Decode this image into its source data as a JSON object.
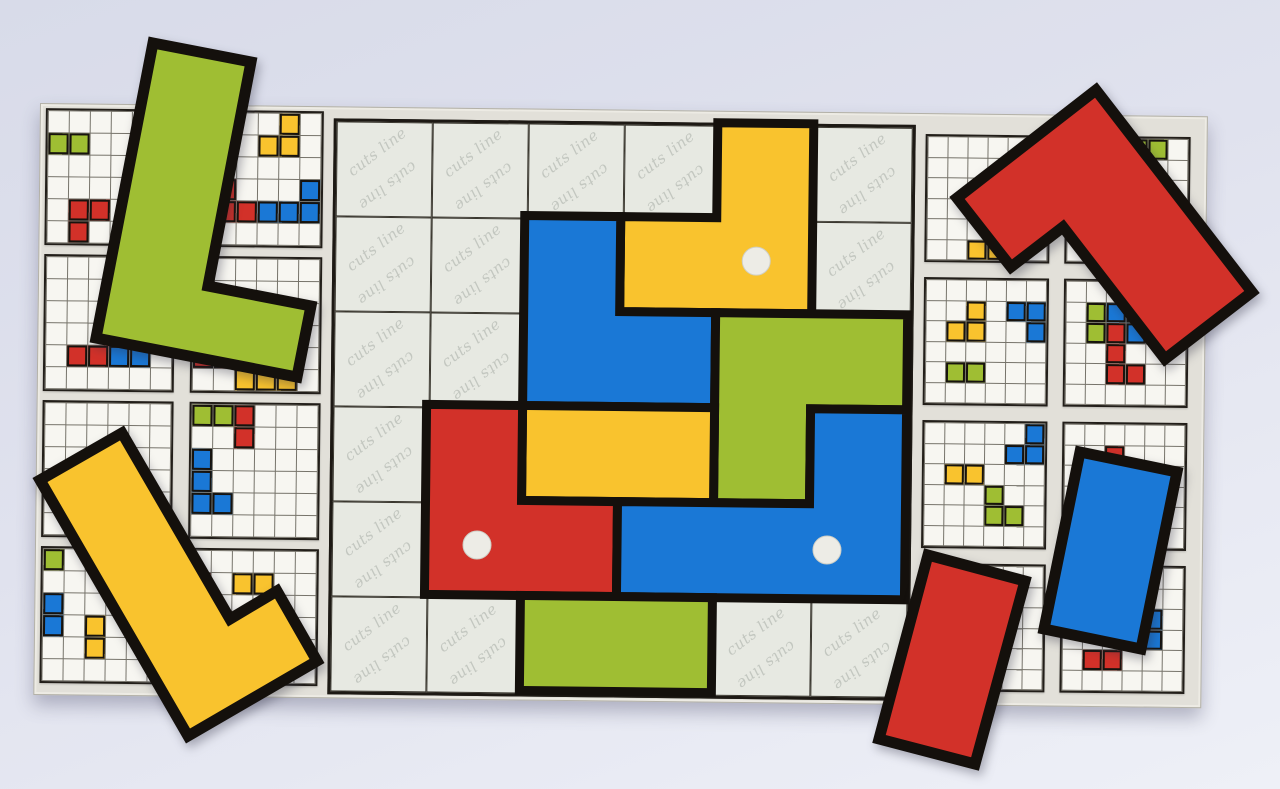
{
  "watermark": {
    "text": "cuts line"
  },
  "palette": {
    "red": "#d23129",
    "yellow": "#f9c32e",
    "green": "#9fbe33",
    "blue": "#1a78d6",
    "outline": "#14100c",
    "board_bg": "#e2e0d9",
    "card_bg": "#f7f6f1",
    "gray_cell": "#e7e9e2",
    "watermark_color": "#c3c7c0",
    "dot": "#edece6"
  },
  "board": {
    "x": 40,
    "y": 103,
    "width": 1166,
    "height": 590,
    "rotation_deg": 0.65
  },
  "center_grid": {
    "x": 293,
    "y": 11,
    "cols": 6,
    "rows": 6,
    "cell_w": 96,
    "cell_h": 95,
    "watermark_cells": [
      [
        0,
        0
      ],
      [
        0,
        1
      ],
      [
        0,
        2
      ],
      [
        0,
        3
      ],
      [
        0,
        5
      ],
      [
        1,
        0
      ],
      [
        1,
        1
      ],
      [
        1,
        5
      ],
      [
        2,
        0
      ],
      [
        2,
        1
      ],
      [
        3,
        0
      ],
      [
        4,
        0
      ],
      [
        5,
        0
      ],
      [
        5,
        1
      ],
      [
        5,
        4
      ],
      [
        5,
        5
      ]
    ]
  },
  "placed_pieces": [
    {
      "name": "yellow-corner-piece-top",
      "color_key": "yellow",
      "cells": [
        [
          0,
          4
        ],
        [
          1,
          3
        ],
        [
          1,
          4
        ]
      ],
      "points": [
        [
          384,
          0
        ],
        [
          480,
          0
        ],
        [
          480,
          190
        ],
        [
          288,
          190
        ],
        [
          288,
          95
        ],
        [
          384,
          95
        ]
      ],
      "dot": [
        424,
        138
      ]
    },
    {
      "name": "blue-corner-piece-top",
      "color_key": "blue",
      "cells": [
        [
          1,
          2
        ],
        [
          2,
          2
        ],
        [
          2,
          3
        ]
      ],
      "points": [
        [
          192,
          95
        ],
        [
          288,
          95
        ],
        [
          288,
          190
        ],
        [
          384,
          190
        ],
        [
          384,
          285
        ],
        [
          192,
          285
        ]
      ],
      "dot": null
    },
    {
      "name": "green-corner-piece-right",
      "color_key": "green",
      "cells": [
        [
          2,
          4
        ],
        [
          2,
          5
        ],
        [
          3,
          4
        ]
      ],
      "points": [
        [
          384,
          190
        ],
        [
          576,
          190
        ],
        [
          576,
          285
        ],
        [
          480,
          285
        ],
        [
          480,
          380
        ],
        [
          384,
          380
        ]
      ],
      "dot": null
    },
    {
      "name": "yellow-domino-piece-middle",
      "color_key": "yellow",
      "cells": [
        [
          3,
          2
        ],
        [
          3,
          3
        ]
      ],
      "points": [
        [
          192,
          285
        ],
        [
          384,
          285
        ],
        [
          384,
          380
        ],
        [
          192,
          380
        ]
      ],
      "dot": null
    },
    {
      "name": "red-corner-piece-left",
      "color_key": "red",
      "cells": [
        [
          3,
          1
        ],
        [
          4,
          1
        ],
        [
          4,
          2
        ]
      ],
      "points": [
        [
          96,
          285
        ],
        [
          192,
          285
        ],
        [
          192,
          380
        ],
        [
          288,
          380
        ],
        [
          288,
          475
        ],
        [
          96,
          475
        ]
      ],
      "dot": [
        148,
        425
      ]
    },
    {
      "name": "blue-l-piece-bottom",
      "color_key": "blue",
      "cells": [
        [
          3,
          5
        ],
        [
          4,
          3
        ],
        [
          4,
          4
        ],
        [
          4,
          5
        ]
      ],
      "points": [
        [
          480,
          285
        ],
        [
          576,
          285
        ],
        [
          576,
          475
        ],
        [
          288,
          475
        ],
        [
          288,
          380
        ],
        [
          480,
          380
        ]
      ],
      "dot": [
        498,
        426
      ]
    },
    {
      "name": "green-domino-piece-bottom",
      "color_key": "green",
      "cells": [
        [
          5,
          2
        ],
        [
          5,
          3
        ]
      ],
      "points": [
        [
          192,
          475
        ],
        [
          384,
          475
        ],
        [
          384,
          570
        ],
        [
          192,
          570
        ]
      ],
      "dot": null
    }
  ],
  "left_panel": {
    "x": 5,
    "y": 4,
    "card_w": 131,
    "card_h": 137,
    "col_gap": 16,
    "row_gap": 9,
    "cards": [
      {
        "id": "L00",
        "cells": [
          [
            0,
            1,
            "green"
          ],
          [
            1,
            1,
            "green"
          ],
          [
            1,
            4,
            "red"
          ],
          [
            2,
            4,
            "red"
          ],
          [
            1,
            5,
            "red"
          ]
        ]
      },
      {
        "id": "L01",
        "cells": [
          [
            4,
            0,
            "yellow"
          ],
          [
            3,
            1,
            "yellow"
          ],
          [
            4,
            1,
            "yellow"
          ],
          [
            1,
            3,
            "red"
          ],
          [
            1,
            4,
            "red"
          ],
          [
            2,
            4,
            "red"
          ],
          [
            5,
            3,
            "blue"
          ],
          [
            3,
            4,
            "blue"
          ],
          [
            4,
            4,
            "blue"
          ],
          [
            5,
            4,
            "blue"
          ]
        ]
      },
      {
        "id": "L10",
        "cells": [
          [
            1,
            4,
            "red"
          ],
          [
            2,
            4,
            "red"
          ],
          [
            3,
            4,
            "blue"
          ],
          [
            4,
            4,
            "blue"
          ]
        ]
      },
      {
        "id": "L11",
        "cells": [
          [
            0,
            4,
            "red"
          ],
          [
            1,
            4,
            "red"
          ],
          [
            4,
            4,
            "yellow"
          ],
          [
            2,
            5,
            "yellow"
          ],
          [
            3,
            5,
            "yellow"
          ],
          [
            4,
            5,
            "yellow"
          ]
        ]
      },
      {
        "id": "L20",
        "cells": [
          [
            4,
            3,
            "blue"
          ],
          [
            4,
            4,
            "blue"
          ]
        ]
      },
      {
        "id": "L21",
        "cells": [
          [
            0,
            0,
            "green"
          ],
          [
            1,
            0,
            "green"
          ],
          [
            2,
            0,
            "red"
          ],
          [
            2,
            1,
            "red"
          ],
          [
            0,
            2,
            "blue"
          ],
          [
            0,
            3,
            "blue"
          ],
          [
            0,
            4,
            "blue"
          ],
          [
            1,
            4,
            "blue"
          ]
        ]
      },
      {
        "id": "L30",
        "cells": [
          [
            0,
            0,
            "green"
          ],
          [
            0,
            2,
            "blue"
          ],
          [
            0,
            3,
            "blue"
          ],
          [
            2,
            3,
            "yellow"
          ],
          [
            2,
            4,
            "yellow"
          ]
        ]
      },
      {
        "id": "L31",
        "cells": [
          [
            0,
            1,
            "red"
          ],
          [
            0,
            2,
            "red"
          ],
          [
            2,
            1,
            "yellow"
          ],
          [
            3,
            1,
            "yellow"
          ]
        ]
      }
    ]
  },
  "right_panel": {
    "x": 885,
    "y": 20,
    "card_w": 125,
    "card_h": 128,
    "col_gap": 15,
    "row_gap": 15,
    "cards": [
      {
        "id": "R00",
        "cells": [
          [
            2,
            5,
            "yellow"
          ],
          [
            3,
            5,
            "yellow"
          ]
        ]
      },
      {
        "id": "R01",
        "cells": [
          [
            3,
            0,
            "green"
          ],
          [
            4,
            0,
            "green"
          ],
          [
            1,
            4,
            "blue"
          ]
        ]
      },
      {
        "id": "R10",
        "cells": [
          [
            2,
            1,
            "yellow"
          ],
          [
            1,
            2,
            "yellow"
          ],
          [
            2,
            2,
            "yellow"
          ],
          [
            4,
            1,
            "blue"
          ],
          [
            5,
            1,
            "blue"
          ],
          [
            5,
            2,
            "blue"
          ],
          [
            1,
            4,
            "green"
          ],
          [
            2,
            4,
            "green"
          ]
        ]
      },
      {
        "id": "R11",
        "cells": [
          [
            1,
            1,
            "green"
          ],
          [
            1,
            2,
            "green"
          ],
          [
            2,
            1,
            "blue"
          ],
          [
            3,
            1,
            "blue"
          ],
          [
            3,
            2,
            "blue"
          ],
          [
            2,
            2,
            "red"
          ],
          [
            2,
            3,
            "red"
          ],
          [
            2,
            4,
            "red"
          ],
          [
            3,
            4,
            "red"
          ]
        ]
      },
      {
        "id": "R20",
        "cells": [
          [
            5,
            0,
            "blue"
          ],
          [
            4,
            1,
            "blue"
          ],
          [
            5,
            1,
            "blue"
          ],
          [
            1,
            2,
            "yellow"
          ],
          [
            2,
            2,
            "yellow"
          ],
          [
            3,
            3,
            "green"
          ],
          [
            3,
            4,
            "green"
          ],
          [
            4,
            4,
            "green"
          ]
        ]
      },
      {
        "id": "R21",
        "cells": [
          [
            2,
            1,
            "red"
          ]
        ]
      },
      {
        "id": "R30",
        "cells": [
          [
            4,
            1,
            "yellow"
          ],
          [
            3,
            3,
            "red"
          ],
          [
            3,
            4,
            "red"
          ]
        ]
      },
      {
        "id": "R31",
        "cells": [
          [
            3,
            2,
            "blue"
          ],
          [
            4,
            2,
            "blue"
          ],
          [
            4,
            3,
            "blue"
          ],
          [
            1,
            4,
            "red"
          ],
          [
            2,
            4,
            "red"
          ]
        ]
      }
    ]
  },
  "loose_pieces": [
    {
      "name": "green-l-piece-loose",
      "color_key": "green",
      "points": [
        [
          153,
          43
        ],
        [
          251,
          62
        ],
        [
          208,
          286
        ],
        [
          311,
          306
        ],
        [
          297,
          377
        ],
        [
          96,
          338
        ]
      ]
    },
    {
      "name": "red-l-piece-loose",
      "color_key": "red",
      "points": [
        [
          957,
          198
        ],
        [
          1096,
          90
        ],
        [
          1252,
          292
        ],
        [
          1165,
          359
        ],
        [
          1063,
          227
        ],
        [
          1011,
          267
        ]
      ]
    },
    {
      "name": "yellow-l-piece-loose",
      "color_key": "yellow",
      "points": [
        [
          40,
          480
        ],
        [
          122,
          433
        ],
        [
          230,
          619
        ],
        [
          277,
          591
        ],
        [
          317,
          661
        ],
        [
          188,
          736
        ]
      ]
    },
    {
      "name": "red-domino-piece-loose",
      "color_key": "red",
      "points": [
        [
          928,
          555
        ],
        [
          1025,
          581
        ],
        [
          975,
          764
        ],
        [
          879,
          739
        ]
      ]
    },
    {
      "name": "blue-domino-piece-loose",
      "color_key": "blue",
      "points": [
        [
          1080,
          452
        ],
        [
          1177,
          472
        ],
        [
          1141,
          649
        ],
        [
          1044,
          629
        ]
      ]
    }
  ]
}
